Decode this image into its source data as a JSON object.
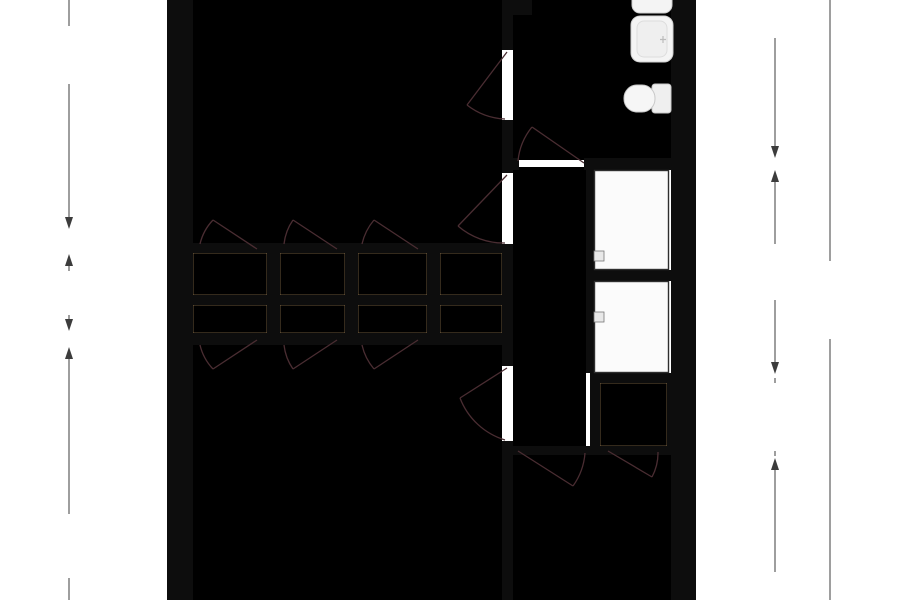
{
  "floorplan": {
    "rooms": {
      "slaapkamer_top": "Slaapkamer",
      "badkamer": "Badkamer",
      "hal": "Hal",
      "slaapkamer_bottom_left": "Slaapkamer",
      "slaapkamer_bottom_right": "Slaapkamer",
      "kast": "Kast"
    },
    "closet_count": 9,
    "dimensions": {
      "left": [
        "4.51 m",
        "1.00 m",
        "5.10 m"
      ],
      "right": [
        "3.78 m",
        "2.57 m",
        "0.75 m",
        "0 m"
      ],
      "total_height": "11.11 m"
    },
    "colors": {
      "room_pink": "#f9d3cf",
      "closet_tan": "#deb98b",
      "hall_yellow": "#f9e5a2",
      "bathroom_lavender": "#c9cadf",
      "wall_black": "#0d0d0d",
      "stair_fill": "#fbfbfb",
      "door_arc": "#4a2d32"
    },
    "icons": {
      "toilet": "toilet-icon",
      "sink": "sink-icon",
      "stairs": "stairs-icon",
      "door": "door-arc-icon"
    }
  }
}
